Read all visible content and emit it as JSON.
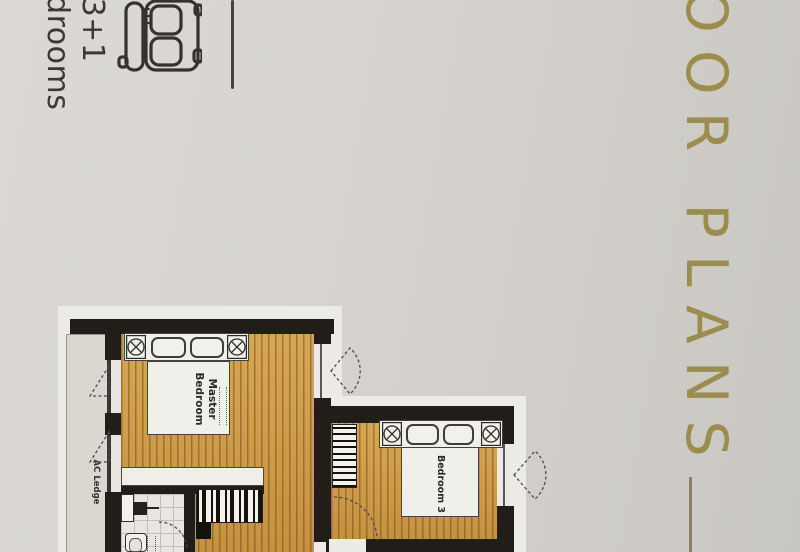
{
  "unit": {
    "line1": "3+1",
    "line2": "Bedrooms"
  },
  "title": {
    "text": "OOR PLANS"
  },
  "plan": {
    "master_label": "Master Bedroom",
    "bedroom3_label": "Bedroom 3",
    "ac_ledge_label": "AC Ledge"
  },
  "icons": {
    "bed_icon": "double-bed-outline",
    "bedside_lamp": "circle-cross-lamp",
    "window_symbol": "dashed-louvre-triangle",
    "door_symbol": "dashed-quarter-arc"
  },
  "colors": {
    "paper": "#d4d1cc",
    "accent_gold": "#9b8d4c",
    "ink": "#3b3936",
    "wall": "#211e19",
    "wood_floor": "#d29c45",
    "plan_white": "#edebe6"
  }
}
